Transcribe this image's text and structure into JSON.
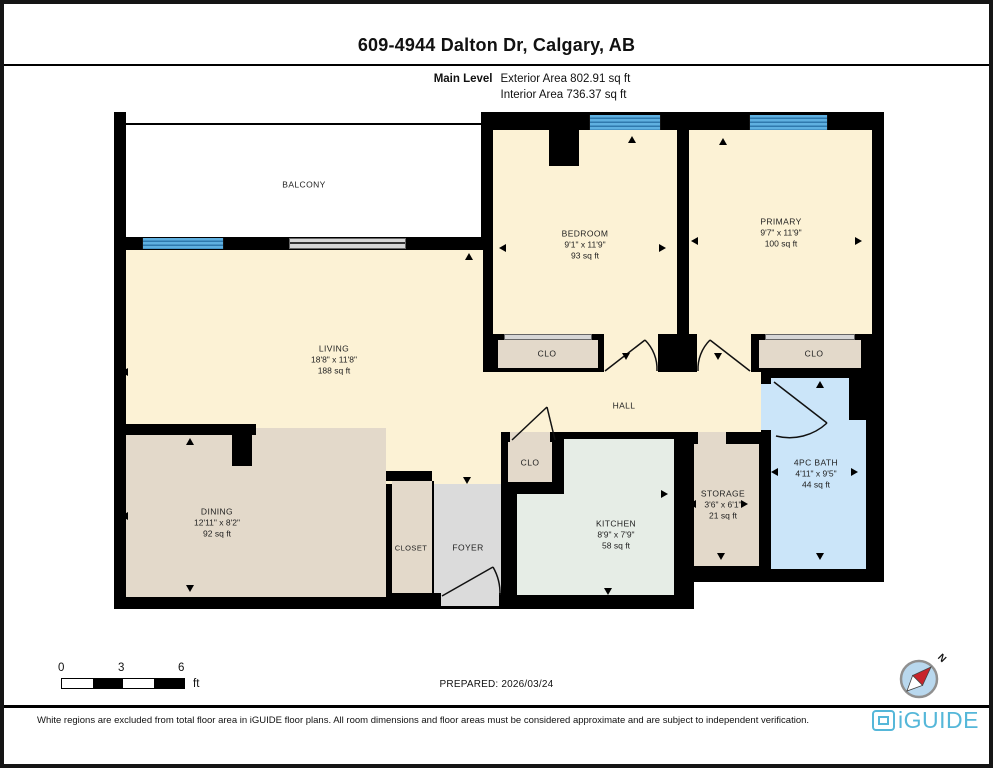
{
  "header": {
    "title": "609-4944 Dalton Dr, Calgary, AB",
    "level_label": "Main Level",
    "exterior_area": "Exterior Area 802.91 sq ft",
    "interior_area": "Interior Area 736.37 sq ft"
  },
  "rooms": {
    "balcony": {
      "name": "BALCONY"
    },
    "bedroom": {
      "name": "BEDROOM",
      "dims": "9'1\" x 11'9\"",
      "area": "93 sq ft"
    },
    "primary": {
      "name": "PRIMARY",
      "dims": "9'7\" x 11'9\"",
      "area": "100 sq ft"
    },
    "living": {
      "name": "LIVING",
      "dims": "18'8\" x 11'8\"",
      "area": "188 sq ft"
    },
    "dining": {
      "name": "DINING",
      "dims": "12'11\" x 8'2\"",
      "area": "92 sq ft"
    },
    "kitchen": {
      "name": "KITCHEN",
      "dims": "8'9\" x 7'9\"",
      "area": "58 sq ft"
    },
    "storage": {
      "name": "STORAGE",
      "dims": "3'6\" x 6'1\"",
      "area": "21 sq ft"
    },
    "bath": {
      "name": "4PC BATH",
      "dims": "4'11\" x 9'5\"",
      "area": "44 sq ft"
    },
    "hall": {
      "name": "HALL"
    },
    "clo": "CLO",
    "closet": "CLOSET",
    "foyer": "FOYER"
  },
  "scale_bar": {
    "ticks": [
      "0",
      "3",
      "6"
    ],
    "unit": "ft"
  },
  "compass": {
    "label": "N"
  },
  "footer": {
    "prepared": "PREPARED: 2026/03/24",
    "disclaimer": "White regions are excluded from total floor area in iGUIDE floor plans. All room dimensions and floor areas must be considered approximate and are subject to independent verification.",
    "brand": "iGUIDE"
  },
  "colors": {
    "wall": "#000000",
    "room_cream": "#fcf2d5",
    "room_tan": "#e3d9ca",
    "room_kitchen": "#e6ede6",
    "room_foyer": "#dbdbdb",
    "room_bath": "#cbe5f9",
    "window_blue": "#4da0d6",
    "brand_blue": "#55b7d9",
    "compass_red": "#c8242b"
  }
}
